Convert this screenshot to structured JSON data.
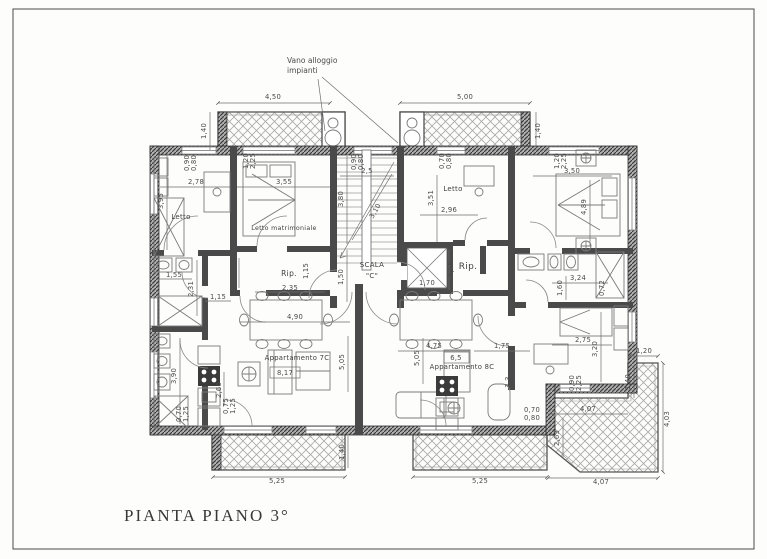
{
  "title": {
    "text": "PIANTA PIANO 3°"
  },
  "annotation": {
    "line1": "Vano alloggio",
    "line2": "impianti"
  },
  "apartments": {
    "left": "Appartamento 7C",
    "right": "Appartamento 8C"
  },
  "colors": {
    "wall": "#4a4a4a",
    "hatch": "#a8a8a8",
    "dim_text": "#4b4b4b",
    "paper": "#fdfdfc"
  },
  "rooms": [
    {
      "t": "Letto",
      "x": 181,
      "y": 219,
      "s": 7
    },
    {
      "t": "Letto matrimoniale",
      "x": 284,
      "y": 230,
      "s": 6.3
    },
    {
      "t": "Letto",
      "x": 453,
      "y": 191,
      "s": 7
    },
    {
      "t": "Rip.",
      "x": 289,
      "y": 276,
      "s": 7.5
    },
    {
      "t": "Rip.",
      "x": 468,
      "y": 269,
      "s": 9
    },
    {
      "t": "SCALA",
      "x": 372,
      "y": 267,
      "s": 7
    },
    {
      "t": "\"C\"",
      "x": 372,
      "y": 278,
      "s": 7
    },
    {
      "t": "Appartamento 7C",
      "x": 297,
      "y": 360,
      "s": 6.8
    },
    {
      "t": "Appartamento 8C",
      "x": 462,
      "y": 369,
      "s": 6.8
    }
  ],
  "dims": [
    {
      "t": "4,50",
      "x": 273,
      "y": 99
    },
    {
      "t": "5,00",
      "x": 465,
      "y": 99
    },
    {
      "t": "1,40",
      "x": 206,
      "y": 131,
      "r": -90
    },
    {
      "t": "1,40",
      "x": 540,
      "y": 131,
      "r": -90
    },
    {
      "t": "2,78",
      "x": 196,
      "y": 184
    },
    {
      "t": "3,55",
      "x": 284,
      "y": 184
    },
    {
      "t": "3,95",
      "x": 163,
      "y": 201,
      "r": -90
    },
    {
      "t": "1,20",
      "x": 248,
      "y": 161,
      "r": -90
    },
    {
      "t": "2,25",
      "x": 255,
      "y": 161,
      "r": -90
    },
    {
      "t": "0,90",
      "x": 189,
      "y": 163,
      "r": -90
    },
    {
      "t": "0,80",
      "x": 196,
      "y": 163,
      "r": -90
    },
    {
      "t": "2,96",
      "x": 449,
      "y": 212
    },
    {
      "t": "3,51",
      "x": 433,
      "y": 198,
      "r": -90
    },
    {
      "t": "0,70",
      "x": 444,
      "y": 161,
      "r": -90
    },
    {
      "t": "0,80",
      "x": 451,
      "y": 161,
      "r": -90
    },
    {
      "t": "3,50",
      "x": 572,
      "y": 173
    },
    {
      "t": "4,89",
      "x": 586,
      "y": 207,
      "r": -90
    },
    {
      "t": "1,20",
      "x": 559,
      "y": 161,
      "r": -90
    },
    {
      "t": "2,25",
      "x": 566,
      "y": 161,
      "r": -90
    },
    {
      "t": "2,5",
      "x": 367,
      "y": 173
    },
    {
      "t": "3,80",
      "x": 343,
      "y": 199,
      "r": -90
    },
    {
      "t": "3,10",
      "x": 377,
      "y": 212,
      "r": -60
    },
    {
      "t": "0,90",
      "x": 356,
      "y": 162,
      "r": -90
    },
    {
      "t": "0,80",
      "x": 363,
      "y": 162,
      "r": -90
    },
    {
      "t": "1,50",
      "x": 343,
      "y": 277,
      "r": -90
    },
    {
      "t": "1,70",
      "x": 427,
      "y": 285
    },
    {
      "t": "1,50",
      "x": 453,
      "y": 269,
      "r": -90
    },
    {
      "t": "1,55",
      "x": 174,
      "y": 277
    },
    {
      "t": "2,31",
      "x": 193,
      "y": 289,
      "r": -90
    },
    {
      "t": "1,16",
      "x": 235,
      "y": 272,
      "r": -90
    },
    {
      "t": "1,15",
      "x": 218,
      "y": 299
    },
    {
      "t": "2,35",
      "x": 290,
      "y": 290
    },
    {
      "t": "1,15",
      "x": 308,
      "y": 271,
      "r": -90
    },
    {
      "t": "4,90",
      "x": 295,
      "y": 319
    },
    {
      "t": "5,05",
      "x": 344,
      "y": 362,
      "r": -90
    },
    {
      "t": "8,17",
      "x": 285,
      "y": 375
    },
    {
      "t": "3,90",
      "x": 176,
      "y": 376,
      "r": -90
    },
    {
      "t": "0,70",
      "x": 181,
      "y": 414,
      "r": -90
    },
    {
      "t": "1,25",
      "x": 188,
      "y": 414,
      "r": -90
    },
    {
      "t": "2,60",
      "x": 221,
      "y": 390,
      "r": -90
    },
    {
      "t": "0,75",
      "x": 228,
      "y": 406,
      "r": -90
    },
    {
      "t": "1,25",
      "x": 235,
      "y": 406,
      "r": -90
    },
    {
      "t": "3,24",
      "x": 578,
      "y": 280
    },
    {
      "t": "1,60",
      "x": 562,
      "y": 288,
      "r": -90
    },
    {
      "t": "0,72",
      "x": 604,
      "y": 288,
      "r": -90
    },
    {
      "t": "2,75",
      "x": 583,
      "y": 342
    },
    {
      "t": "3,20",
      "x": 597,
      "y": 349,
      "r": -90
    },
    {
      "t": "0,90",
      "x": 574,
      "y": 383,
      "r": -90
    },
    {
      "t": "2,25",
      "x": 581,
      "y": 383,
      "r": -90
    },
    {
      "t": "4,75",
      "x": 434,
      "y": 348
    },
    {
      "t": "1,75",
      "x": 502,
      "y": 348
    },
    {
      "t": "6,5",
      "x": 456,
      "y": 360
    },
    {
      "t": "5,05",
      "x": 419,
      "y": 358,
      "r": -90
    },
    {
      "t": "3,3",
      "x": 510,
      "y": 382,
      "r": -90
    },
    {
      "t": "0,70",
      "x": 532,
      "y": 412
    },
    {
      "t": "0,80",
      "x": 532,
      "y": 420
    },
    {
      "t": "5,25",
      "x": 277,
      "y": 483
    },
    {
      "t": "5,25",
      "x": 480,
      "y": 483
    },
    {
      "t": "1,40",
      "x": 344,
      "y": 452,
      "r": -90
    },
    {
      "t": "4,07",
      "x": 601,
      "y": 484
    },
    {
      "t": "4,03",
      "x": 669,
      "y": 419,
      "r": -90
    },
    {
      "t": "1,20",
      "x": 644,
      "y": 353
    },
    {
      "t": "1,40",
      "x": 630,
      "y": 382,
      "r": -90
    },
    {
      "t": "4,07",
      "x": 588,
      "y": 411
    },
    {
      "t": "2,63",
      "x": 559,
      "y": 438,
      "r": -90
    }
  ]
}
